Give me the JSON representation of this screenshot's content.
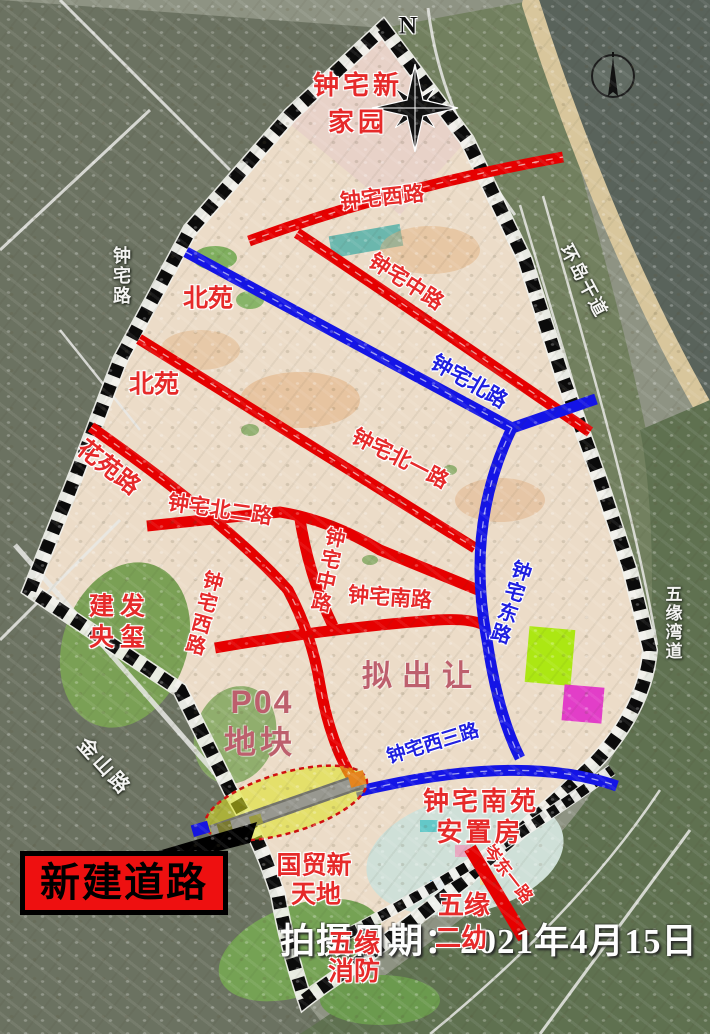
{
  "caption": "拍摄日期：2021年4月15日",
  "legend": {
    "new_road_label": "新建道路"
  },
  "compass": {
    "north_letter": "N"
  },
  "colors": {
    "new_road_red": "#e60000",
    "planned_road_blue": "#1414e6",
    "highlight_yellow": "#dde41e",
    "legend_box_red": "#ee1010",
    "label_red": "#e62a2a",
    "label_blue": "#2020e0"
  },
  "labels": {
    "zhongzhai_xinjiayuan_l1": "钟宅新",
    "zhongzhai_xinjiayuan_l2": "家园",
    "zhongzhai_xilu_top": "钟宅西路",
    "beiyuan_1": "北苑",
    "zhongzhai_zhonglu_n": "钟宅中路",
    "zhongzhai_beilu": "钟宅北路",
    "beiyuan_2": "北苑",
    "huayuan_lu": "花苑路",
    "zhongzhai_beiyilu": "钟宅北一路",
    "zhongzhai_beierlu": "钟宅北二路",
    "zhongzhai_zhonglu_s": "钟宅中路",
    "zhongzhai_nanlu": "钟宅南路",
    "zhongzhai_donglu": "钟宅东路",
    "zhongzhai_xilu_w": "钟宅西路",
    "jianfa_yangxi_l1": "建发",
    "jianfa_yangxi_l2": "央玺",
    "jinshan_lu": "金山路",
    "zhongzhai_lu": "钟宅路",
    "huandao_gandao": "环岛干道",
    "wuyuanwan_dao": "五缘湾道",
    "p04_l1": "P04",
    "p04_l2": "地块",
    "ni_churang": "拟出让",
    "zhongzhai_xisanlu": "钟宅西三路",
    "nanyuan_anzhifang_l1": "钟宅南苑",
    "nanyuan_anzhifang_l2": "安置房",
    "cendong_yilu": "岑东一路",
    "wuyuan_eryou_l1": "五缘",
    "wuyuan_eryou_l2": "二幼",
    "wuyuan_xiaofang_l1": "五缘",
    "wuyuan_xiaofang_l2": "消防",
    "guomao_xintiandi_l1": "国贸新",
    "guomao_xintiandi_l2": "天地"
  }
}
